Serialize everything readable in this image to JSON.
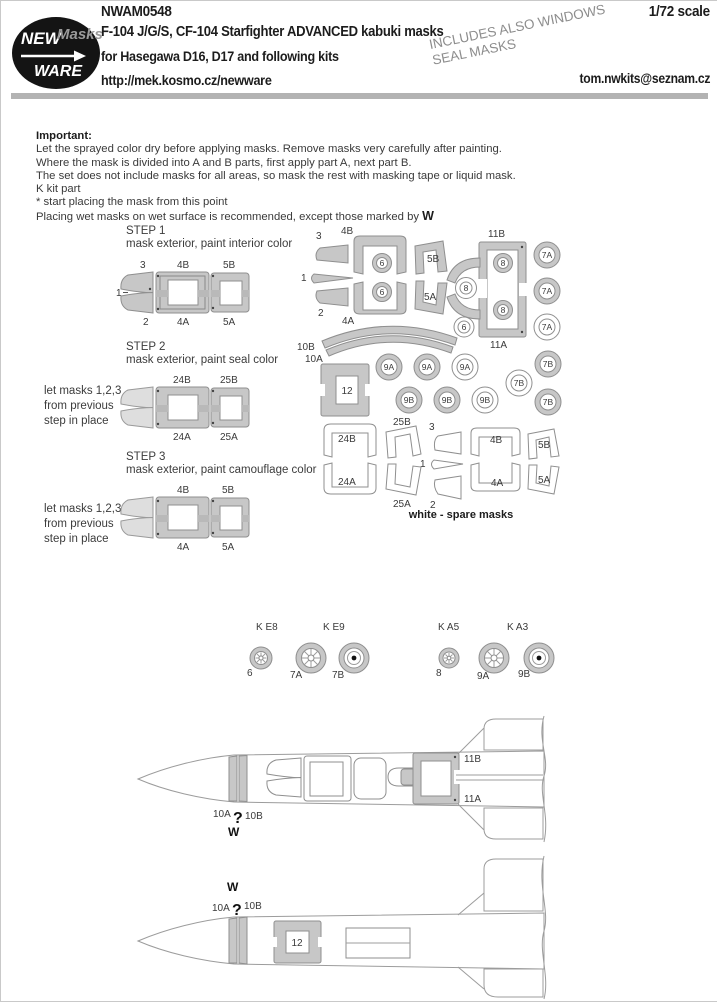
{
  "colors": {
    "mask_gray": "#c7c7c7",
    "mask_outline": "#8f8f8f",
    "divider_gray": "#b3b3b3",
    "note_gray": "#8d8d8d"
  },
  "header": {
    "code": "NWAM0548",
    "scale": "1/72 scale",
    "title": "F-104 J/G/S, CF-104 Starfighter ADVANCED  kabuki masks",
    "subtitle": "for Hasegawa D16, D17  and following kits",
    "url": "http://mek.kosmo.cz/newware",
    "email": "tom.nwkits@seznam.cz",
    "note_line1": "INCLUDES ALSO WINDOWS",
    "note_line2": "SEAL MASKS",
    "logo_new": "NEW",
    "logo_masks": "Masks",
    "logo_ware": "WARE"
  },
  "important": {
    "heading": "Important:",
    "line1": "Let the sprayed color dry before applying masks. Remove masks very carefully after painting.",
    "line2": "Where the mask is divided into A and B parts, first apply part A, next part B.",
    "line3": "The set does not include masks for all areas, so mask the rest with masking tape or liquid mask.",
    "line4": "K kit part",
    "line5": "*  start placing the mask from this point",
    "line6": "Placing wet masks on wet surface is recommended, except those marked by",
    "w_mark": "W"
  },
  "step1": {
    "title": "STEP 1",
    "desc": "mask exterior, paint interior color",
    "l3": "3",
    "l1": "1",
    "l2": "2",
    "ltm": "4B",
    "ltr": "5B",
    "lbm": "4A",
    "lbr": "5A"
  },
  "step2": {
    "title": "STEP 2",
    "desc": "mask exterior, paint seal color",
    "note1": "let masks 1,2,3",
    "note2": "from previous",
    "note3": "step in place",
    "ltm": "24B",
    "ltr": "25B",
    "lbm": "24A",
    "lbr": "25A"
  },
  "step3": {
    "title": "STEP 3",
    "desc": "mask exterior, paint camouflage color",
    "note1": "let masks 1,2,3",
    "note2": "from previous",
    "note3": "step in place",
    "ltm": "4B",
    "ltr": "5B",
    "lbm": "4A",
    "lbr": "5A"
  },
  "sheet": {
    "w3": "3",
    "w1": "1",
    "w2": "2",
    "b4b": "4B",
    "b4a": "4A",
    "b5b": "5B",
    "b5a": "5A",
    "c6_1": "6",
    "c6_2": "6",
    "c6_3": "6",
    "f11b": "11B",
    "f11a": "11A",
    "c8_1": "8",
    "c8_2": "8",
    "c8_3": "8",
    "c7a_1": "7A",
    "c7a_2": "7A",
    "c7a_3": "7A",
    "a10b": "10B",
    "a10a": "10A",
    "f12": "12",
    "c9a_1": "9A",
    "c9a_2": "9A",
    "c9a_3": "9A",
    "c9b_1": "9B",
    "c9b_2": "9B",
    "c9b_3": "9B",
    "c7b_1": "7B",
    "c7b_2": "7B",
    "c7b_3": "7B",
    "s24b": "24B",
    "s24a": "24A",
    "s25b": "25B",
    "s25a": "25A",
    "s3": "3",
    "s1": "1",
    "s2": "2",
    "s4b": "4B",
    "s4a": "4A",
    "s5b": "5B",
    "s5a": "5A",
    "caption": "white - spare masks"
  },
  "wheels": {
    "ke8": "K E8",
    "ke9": "K E9",
    "ka5": "K A5",
    "ka3": "K A3",
    "l6": "6",
    "l7a": "7A",
    "l7b": "7B",
    "l8": "8",
    "l9a": "9A",
    "l9b": "9B"
  },
  "topview": {
    "l10a": "10A",
    "q": "?",
    "l10b": "10B",
    "w": "W",
    "l11b": "11B",
    "l11a": "11A"
  },
  "bottomview": {
    "w": "W",
    "l10a": "10A",
    "q": "?",
    "l10b": "10B",
    "l12": "12"
  }
}
